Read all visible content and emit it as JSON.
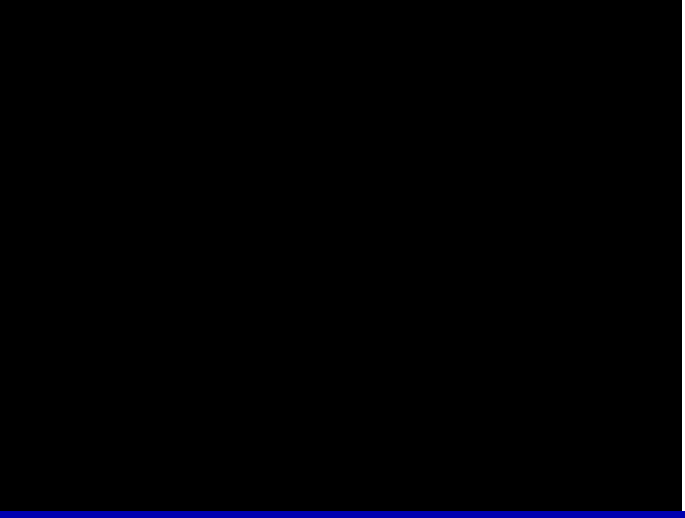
{
  "colors": {
    "wall": "#00ff00",
    "window": "#00ffff",
    "bed": "#0000ee",
    "yellow": "#ffff00",
    "red": "#ff1515",
    "magenta": "#ff00ff",
    "title": "#2222ff",
    "bar": "#0000b0",
    "white": "#ffffff"
  },
  "texts": [
    {
      "name": "figure-label",
      "text": "图五",
      "x": 62,
      "y": 37,
      "color": "#2222ff",
      "size": 14
    },
    {
      "name": "label-kan-96",
      "text": "坎96四泄生",
      "x": 207,
      "y": 36,
      "size": 13
    },
    {
      "name": "label-chou-28",
      "text": "丑向28二绝煞",
      "x": 397,
      "y": 7,
      "size": 13
    },
    {
      "name": "label-qian-41",
      "text": "乾41九祸死",
      "x": 41,
      "y": 126,
      "size": 13
    },
    {
      "name": "label-dui-39",
      "text": "兑39一六煞",
      "x": 70,
      "y": 425,
      "size": 13
    },
    {
      "name": "label-wei-85",
      "text": "未山85五五生",
      "x": 279,
      "y": 497,
      "size": 13
    },
    {
      "name": "label-li-17",
      "text": "离17三天死",
      "x": 512,
      "y": 494,
      "size": 13
    },
    {
      "name": "label-zhen-74",
      "text": "震74六延死",
      "x": 634,
      "y": 54,
      "size": 13,
      "vertical": true
    },
    {
      "name": "label-xun-63",
      "text": "巽63七伏旺",
      "x": 658,
      "y": 287,
      "size": 13,
      "vertical": true
    },
    {
      "name": "room-balcony",
      "text": "阳台",
      "x": 329,
      "y": 50,
      "size": 11
    },
    {
      "name": "room-kitchen",
      "text": "厨房",
      "x": 251,
      "y": 124,
      "size": 11
    },
    {
      "name": "room-study",
      "text": "书房",
      "x": 55,
      "y": 185,
      "size": 11
    },
    {
      "name": "room-dining",
      "text": "餐厅",
      "x": 173,
      "y": 216,
      "size": 11
    },
    {
      "name": "room-living",
      "text": "客厅",
      "x": 386,
      "y": 160,
      "size": 11
    },
    {
      "name": "room-son-bedroom",
      "text": "儿子房",
      "x": 524,
      "y": 166,
      "size": 11
    },
    {
      "name": "room-guest-right",
      "text": "客房",
      "x": 562,
      "y": 239,
      "size": 11
    },
    {
      "name": "room-washroom-left",
      "text": "洗手间",
      "x": 250,
      "y": 344,
      "size": 11
    },
    {
      "name": "room-toilet",
      "text": "厕所",
      "x": 266,
      "y": 417,
      "size": 11
    },
    {
      "name": "room-guest-center",
      "text": "客房",
      "x": 319,
      "y": 352,
      "size": 11
    },
    {
      "name": "room-master-bedroom",
      "text": "主人房",
      "x": 489,
      "y": 379,
      "size": 11
    },
    {
      "name": "room-washroom-right",
      "text": "洗手间",
      "x": 574,
      "y": 349,
      "size": 11
    },
    {
      "name": "room-bathroom",
      "text": "卫生间",
      "x": 589,
      "y": 418,
      "size": 11
    }
  ],
  "compass": {
    "cx": 351,
    "cy": 398,
    "line_angles": [
      25,
      65,
      115,
      155
    ],
    "line_length": 175,
    "numbers": [
      {
        "name": "compass-96",
        "text": "96",
        "x": 333,
        "y": 369
      },
      {
        "name": "compass-28",
        "text": "28",
        "x": 349,
        "y": 368
      },
      {
        "name": "compass-41",
        "text": "41",
        "x": 320,
        "y": 384
      },
      {
        "name": "compass-74",
        "text": "74",
        "x": 363,
        "y": 383
      },
      {
        "name": "compass-39",
        "text": "39",
        "x": 318,
        "y": 399
      },
      {
        "name": "compass-63",
        "text": "63",
        "x": 368,
        "y": 399
      },
      {
        "name": "compass-85",
        "text": "85",
        "x": 335,
        "y": 415
      },
      {
        "name": "compass-17",
        "text": "17",
        "x": 353,
        "y": 412
      }
    ]
  },
  "walls": [
    {
      "name": "balcony-top",
      "r": [
        296,
        29,
        172,
        2
      ]
    },
    {
      "name": "balcony-left",
      "r": [
        296,
        29,
        2,
        66
      ]
    },
    {
      "name": "balcony-right",
      "r": [
        466,
        29,
        2,
        36
      ]
    },
    {
      "name": "living-top",
      "r": [
        296,
        94,
        172,
        1
      ]
    },
    {
      "name": "kitchen-outer-top",
      "r": [
        177,
        64,
        134,
        2
      ]
    },
    {
      "name": "kitchen-outer-left",
      "r": [
        177,
        64,
        2,
        100
      ]
    },
    {
      "name": "hall-top",
      "r": [
        22,
        162,
        157,
        2
      ]
    },
    {
      "name": "west-outer",
      "r": [
        22,
        162,
        2,
        166
      ]
    },
    {
      "name": "south-band-top",
      "r": [
        27,
        316,
        477,
        1
      ]
    },
    {
      "name": "south-band-bottom",
      "r": [
        22,
        327,
        620,
        1
      ]
    },
    {
      "name": "entry-step-h",
      "r": [
        16,
        316,
        11,
        1
      ]
    },
    {
      "name": "entry-step-v",
      "r": [
        16,
        316,
        1,
        14
      ]
    },
    {
      "name": "living-right-inner",
      "r": [
        457,
        64,
        1,
        147
      ]
    },
    {
      "name": "living-right-outer",
      "r": [
        462,
        64,
        1,
        147
      ]
    },
    {
      "name": "son-room-top",
      "r": [
        457,
        64,
        124,
        1
      ]
    },
    {
      "name": "son-room-step-h",
      "r": [
        466,
        52,
        72,
        1
      ]
    },
    {
      "name": "son-room-step-v",
      "r": [
        537,
        52,
        1,
        13
      ]
    },
    {
      "name": "son-room-right-inner",
      "r": [
        573,
        64,
        1,
        132
      ]
    },
    {
      "name": "son-room-right-outer",
      "r": [
        584,
        64,
        1,
        132
      ]
    },
    {
      "name": "son-room-bottom",
      "r": [
        457,
        210,
        62,
        1
      ]
    },
    {
      "name": "ne-step-1h",
      "r": [
        584,
        195,
        69,
        1
      ]
    },
    {
      "name": "ne-step-1v",
      "r": [
        652,
        195,
        1,
        34
      ]
    },
    {
      "name": "ne-step-2h",
      "r": [
        590,
        203,
        57,
        1
      ]
    },
    {
      "name": "ne-step-2v",
      "r": [
        646,
        203,
        1,
        26
      ]
    },
    {
      "name": "guest-right-top",
      "r": [
        497,
        218,
        144,
        1
      ]
    },
    {
      "name": "guest-right-left",
      "r": [
        503,
        257,
        1,
        71
      ]
    },
    {
      "name": "east-wall",
      "r": [
        640,
        206,
        1,
        266
      ]
    },
    {
      "name": "washroom-left-wall-l",
      "r": [
        240,
        317,
        1,
        154
      ]
    },
    {
      "name": "washroom-left-wall-r",
      "r": [
        297,
        317,
        1,
        154
      ]
    },
    {
      "name": "washroom-toilet-divider",
      "r": [
        240,
        385,
        57,
        1
      ]
    },
    {
      "name": "guest-center-left",
      "r": [
        303,
        327,
        1,
        144
      ]
    },
    {
      "name": "guest-center-right",
      "r": [
        393,
        317,
        1,
        154
      ]
    },
    {
      "name": "master-left",
      "r": [
        405,
        317,
        1,
        154
      ]
    },
    {
      "name": "master-right",
      "r": [
        546,
        357,
        1,
        114
      ]
    },
    {
      "name": "washroom-right-left",
      "r": [
        548,
        329,
        1,
        142
      ]
    },
    {
      "name": "washroom-right-top",
      "r": [
        548,
        329,
        92,
        1
      ]
    },
    {
      "name": "washroom-bath-divider",
      "r": [
        548,
        385,
        92,
        1
      ]
    },
    {
      "name": "south-wall-1",
      "r": [
        230,
        470,
        96,
        1
      ]
    },
    {
      "name": "south-wall-2",
      "r": [
        375,
        470,
        66,
        1
      ]
    },
    {
      "name": "south-wall-3",
      "r": [
        508,
        470,
        63,
        1
      ]
    },
    {
      "name": "bay1-l",
      "r": [
        325,
        470,
        1,
        22
      ]
    },
    {
      "name": "bay1-b",
      "r": [
        325,
        491,
        51,
        1
      ]
    },
    {
      "name": "bay1-r",
      "r": [
        375,
        470,
        1,
        22
      ]
    },
    {
      "name": "bay2-l",
      "r": [
        440,
        470,
        1,
        17
      ]
    },
    {
      "name": "bay2-b",
      "r": [
        440,
        486,
        69,
        1
      ]
    },
    {
      "name": "bay2-r",
      "r": [
        508,
        470,
        1,
        17
      ]
    },
    {
      "name": "bay3-l",
      "r": [
        570,
        470,
        1,
        22
      ]
    },
    {
      "name": "bay3-b",
      "r": [
        570,
        491,
        86,
        1
      ]
    },
    {
      "name": "se-outer-v",
      "r": [
        655,
        412,
        1,
        80
      ]
    },
    {
      "name": "se-outer-h",
      "r": [
        641,
        412,
        15,
        1
      ]
    },
    {
      "name": "toilet-outer-left",
      "r": [
        231,
        440,
        1,
        31
      ]
    }
  ],
  "outlines": [
    {
      "name": "balcony-inner",
      "r": [
        303,
        41,
        157,
        46
      ]
    },
    {
      "name": "kitchen-inner",
      "r": [
        186,
        74,
        111,
        88
      ]
    },
    {
      "name": "study-outer",
      "r": [
        20,
        166,
        90,
        114
      ]
    },
    {
      "name": "study-inner",
      "r": [
        30,
        174,
        72,
        97
      ]
    },
    {
      "name": "son-shelf-top",
      "r": [
        477,
        59,
        52,
        8
      ]
    },
    {
      "name": "son-shelf-bottom",
      "r": [
        468,
        172,
        50,
        9
      ]
    },
    {
      "name": "master-wardrobe",
      "r": [
        399,
        356,
        71,
        9
      ],
      "mid": true
    },
    {
      "name": "bay1-ledge",
      "r": [
        334,
        478,
        30,
        5
      ]
    },
    {
      "name": "bay2-ledge",
      "r": [
        450,
        479,
        48,
        4
      ]
    },
    {
      "name": "bay3-ledge",
      "r": [
        588,
        478,
        45,
        5
      ]
    }
  ],
  "windows": [
    {
      "name": "balcony-window",
      "r": [
        368,
        85,
        31,
        10
      ],
      "o": "h"
    },
    {
      "name": "kitchen-window",
      "r": [
        188,
        160,
        31,
        12
      ],
      "o": "h"
    },
    {
      "name": "study-door",
      "r": [
        102,
        173,
        12,
        31
      ],
      "o": "v"
    },
    {
      "name": "hall-window",
      "r": [
        315,
        189,
        12,
        28
      ],
      "o": "v"
    },
    {
      "name": "son-room-window",
      "r": [
        466,
        203,
        31,
        11
      ],
      "o": "h"
    },
    {
      "name": "band-window-1",
      "r": [
        242,
        318,
        31,
        10
      ],
      "o": "h"
    },
    {
      "name": "band-window-2",
      "r": [
        366,
        318,
        29,
        10
      ],
      "o": "h"
    },
    {
      "name": "band-window-3",
      "r": [
        405,
        318,
        32,
        10
      ],
      "o": "h"
    },
    {
      "name": "guest-right-door",
      "r": [
        500,
        214,
        9,
        44
      ],
      "o": "v"
    },
    {
      "name": "master-door",
      "r": [
        543,
        329,
        7,
        29
      ],
      "o": "v"
    },
    {
      "name": "washroom-left-door",
      "r": [
        266,
        381,
        29,
        5
      ],
      "o": "h"
    },
    {
      "name": "washroom-right-window",
      "r": [
        575,
        383,
        32,
        5
      ],
      "o": "h"
    }
  ],
  "furniture": [
    {
      "name": "stove",
      "type": "stove",
      "r": [
        219,
        73,
        28,
        19
      ]
    },
    {
      "name": "kitchen-sink",
      "type": "sink",
      "r": [
        258,
        74,
        24,
        22
      ]
    },
    {
      "name": "sofa",
      "type": "sofa",
      "r": [
        306,
        96,
        30,
        88
      ]
    },
    {
      "name": "tv",
      "type": "tv",
      "r": [
        442,
        144,
        17,
        28
      ]
    },
    {
      "name": "son-bed",
      "type": "bed",
      "r": [
        466,
        92,
        74,
        59
      ]
    },
    {
      "name": "son-fan-top",
      "type": "fanbox",
      "r": [
        466,
        74,
        19,
        17
      ],
      "border": "#00ffff"
    },
    {
      "name": "son-fan-bottom",
      "type": "fanbox",
      "r": [
        466,
        150,
        19,
        17
      ],
      "border": "#0000ee"
    },
    {
      "name": "guest-right-bed-1",
      "type": "twinbed",
      "r": [
        557,
        261,
        72,
        25
      ]
    },
    {
      "name": "guest-right-bed-2",
      "type": "twinbed",
      "r": [
        557,
        294,
        72,
        23
      ]
    },
    {
      "name": "study-desk",
      "type": "desk",
      "r": [
        50,
        213,
        37,
        56
      ]
    },
    {
      "name": "study-computer",
      "type": "deskset",
      "r": [
        60,
        216,
        20,
        32
      ]
    },
    {
      "name": "study-round-table",
      "type": "roundtable",
      "r": [
        31,
        226,
        27,
        25
      ]
    },
    {
      "name": "dining-table",
      "type": "dtable",
      "r": [
        119,
        228,
        46,
        27
      ]
    },
    {
      "name": "dining-chair-1",
      "type": "dchair",
      "r": [
        122,
        211,
        16,
        17
      ]
    },
    {
      "name": "dining-chair-2",
      "type": "dchair",
      "r": [
        142,
        211,
        16,
        17
      ]
    },
    {
      "name": "dining-chair-3",
      "type": "dchair",
      "r": [
        122,
        256,
        16,
        17
      ]
    },
    {
      "name": "dining-chair-4",
      "type": "dchair",
      "r": [
        142,
        256,
        16,
        17
      ]
    },
    {
      "name": "guest-center-bed",
      "type": "bed",
      "r": [
        304,
        386,
        75,
        57
      ]
    },
    {
      "name": "guest-center-fan-top",
      "type": "fanbox",
      "r": [
        303,
        366,
        20,
        18
      ],
      "border": "#00ffff"
    },
    {
      "name": "guest-center-fan-bottom",
      "type": "fanbox",
      "r": [
        303,
        440,
        20,
        18
      ],
      "border": "#0000ee"
    },
    {
      "name": "master-bed",
      "type": "bed",
      "r": [
        405,
        384,
        74,
        59
      ]
    },
    {
      "name": "master-fan-top",
      "type": "fanbox",
      "r": [
        404,
        366,
        20,
        18
      ],
      "border": "#00ffff"
    },
    {
      "name": "master-fan-bottom",
      "type": "fanbox",
      "r": [
        404,
        440,
        21,
        19
      ],
      "border": "#0000ee"
    },
    {
      "name": "washroom-left-sink",
      "type": "sink",
      "r": [
        242,
        364,
        21,
        21
      ]
    },
    {
      "name": "toilet-left",
      "type": "toileth",
      "r": [
        239,
        435,
        36,
        23
      ]
    },
    {
      "name": "washroom-right-sink",
      "type": "sink",
      "r": [
        550,
        363,
        22,
        21
      ]
    },
    {
      "name": "bathtub",
      "type": "bathtub",
      "r": [
        550,
        410,
        30,
        60
      ]
    },
    {
      "name": "toilet-right",
      "type": "toiletv",
      "r": [
        601,
        436,
        26,
        33
      ]
    }
  ]
}
